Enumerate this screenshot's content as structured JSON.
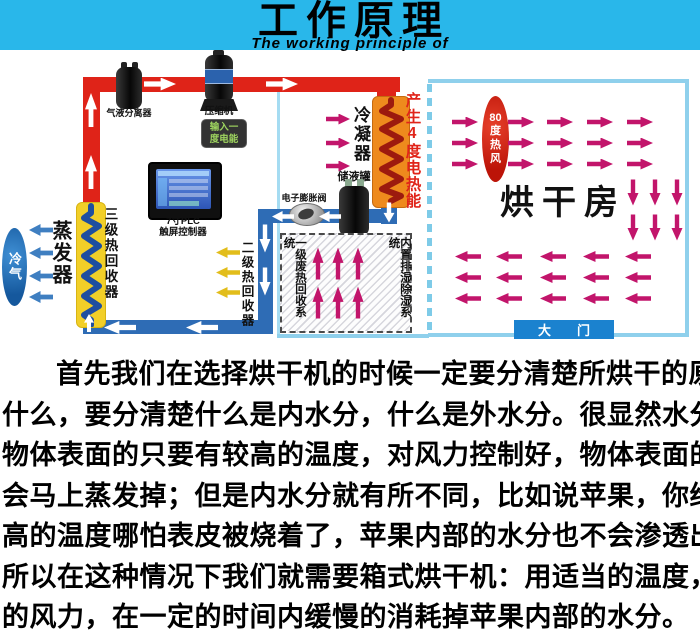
{
  "header": {
    "title": "工作原理",
    "subtitle": "The working principle of"
  },
  "diagram": {
    "machine_room": {
      "separator_label": "气液分离器",
      "compressor_label": "压缩机",
      "compressor_badge_line1": "输入一",
      "compressor_badge_line2": "度电能",
      "plc_label_line1": "7寸PLC",
      "plc_label_line2": "触屏控制器",
      "tertiary_recovery_label": "三级热回收器",
      "evaporator_label": "蒸发器",
      "cold_air_label": "冷气",
      "secondary_recovery_label": "二级热回收器"
    },
    "middle_room": {
      "condenser_label": "冷凝器",
      "heat_note": "产生4度电热能",
      "expansion_valve_label": "电子膨胀阀",
      "receiver_label": "储液罐",
      "waste_heat_label": "一级废热回收系统",
      "dehumidify_label": "内置排湿除湿系统"
    },
    "drying_room": {
      "hot_wind_label": "80度热风",
      "room_label": "烘干房",
      "door_label": "大门"
    },
    "colors": {
      "header_cyan": "#29b7ea",
      "white": "#ffffff",
      "pipe_hot": "#df2318",
      "pipe_cold": "#2e6cb5",
      "condenser_body": "#ee8a1d",
      "condenser_coil": "#9c1a0e",
      "coil_box_yellow": "#f2cf28",
      "coil_blue": "#1e4ea0",
      "arrow_magenta": "#c2156b",
      "arrow_yellow": "#e2bd1b",
      "arrow_blue": "#3f7fc1",
      "room_border": "#8fd0ec",
      "wall_dashed": "#7ecbe8",
      "door_blue": "#1b82cf",
      "oval_red": "#d7271d",
      "oval_blue": "#2272bb",
      "heat_text_red": "#e0241a",
      "badge_green": "#9ed45f"
    }
  },
  "paragraph": {
    "lines": [
      "首先我们在选择烘干机的时候一定要分清楚所烘干的原料是",
      "什么，要分清楚什么是内水分，什么是外水分。很显然水分是在",
      "物体表面的只要有较高的温度，对风力控制好，物体表面的水分",
      "会马上蒸发掉；但是内水分就有所不同，比如说苹果，你给它超",
      "高的温度哪怕表皮被烧着了，苹果内部的水分也不会渗透出来，",
      "所以在这种情况下我们就需要箱式烘干机：用适当的温度，适当",
      "的风力，在一定的时间内缓慢的消耗掉苹果内部的水分。"
    ]
  }
}
